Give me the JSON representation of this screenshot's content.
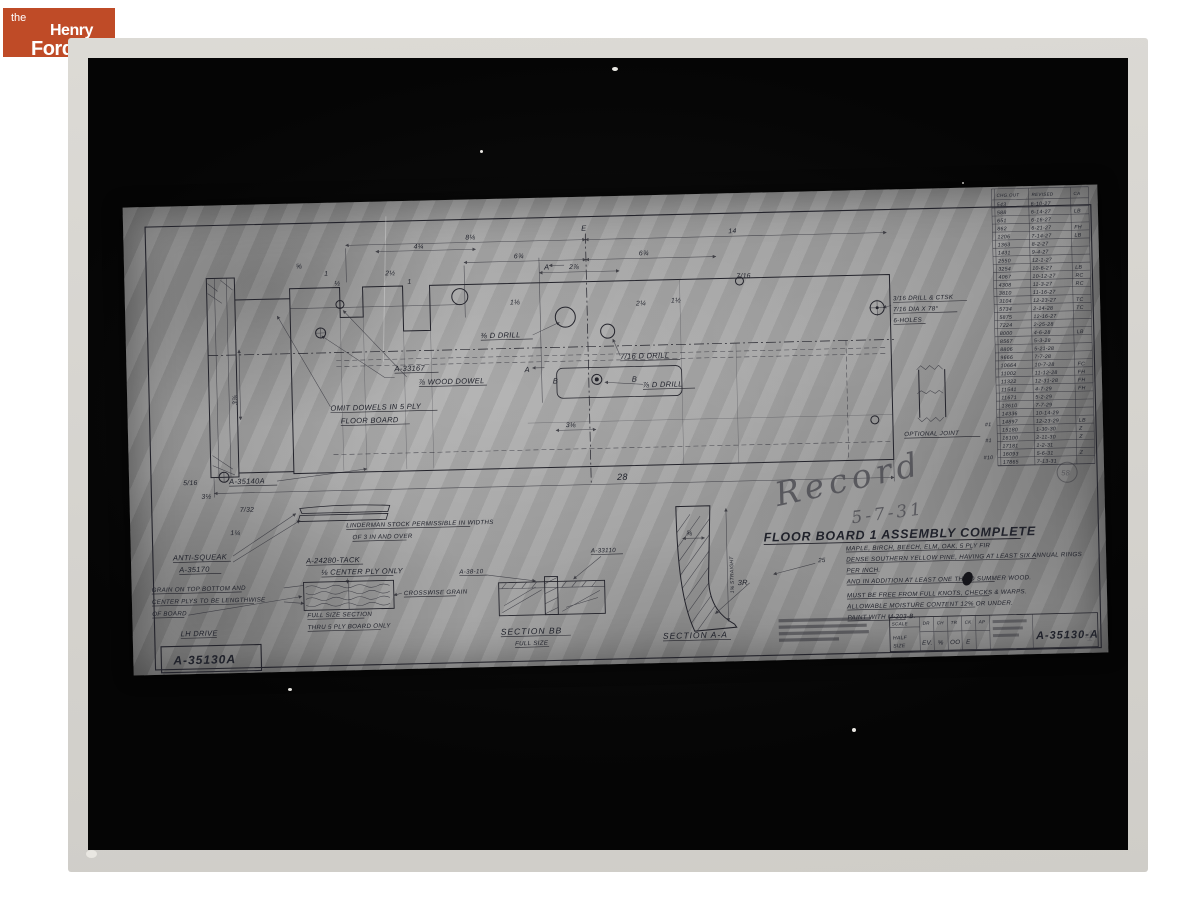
{
  "logo": {
    "the": "the",
    "henry": "Henry",
    "ford": "Ford",
    "bg": "#bf4b27"
  },
  "sheet": {
    "record": "Record",
    "record_date": "5-7-31",
    "title": "FLOOR BOARD 1 ASSEMBLY COMPLETE",
    "notes": [
      "MAPLE, BIRCH, BEECH, ELM, OAK, 5 PLY FIR",
      "DENSE SOUTHERN YELLOW PINE, HAVING AT LEAST SIX ANNUAL RINGS",
      "PER INCH.",
      "AND IN ADDITION AT LEAST ONE THIRD SUMMER WOOD.",
      "MUST BE FREE FROM FULL KNOTS, CHECKS & WARPS.",
      "ALLOWABLE MOISTURE CONTENT 12% OR UNDER.",
      "PAINT WITH M-203-B."
    ],
    "note_margin": "25",
    "labels": {
      "dowel_part": "A-33167",
      "dowel": "⅞ WOOD DOWEL",
      "omit1": "OMIT DOWELS IN 5 PLY",
      "omit2": "FLOOR BOARD",
      "a35140": "A-35140A",
      "anti1": "ANTI-SQUEAK",
      "anti2": "A-35170",
      "grain1": "GRAIN ON TOP BOTTOM AND",
      "grain2": "CENTER PLYS TO BE LENGTHWISE",
      "grain3": "OF BOARD",
      "lh": "LH DRIVE",
      "lind1": "LINDERMAN STOCK PERMISSIBLE IN WIDTHS",
      "lind2": "OF 3 IN AND OVER",
      "tack1": "A-24280-TACK",
      "tack2": "⅛ CENTER PLY ONLY",
      "full1": "FULL SIZE SECTION",
      "full2": "THRU 5 PLY BOARD ONLY",
      "cross": "CROSSWISE GRAIN",
      "a3810": "A-38-10",
      "a33110": "A-33110",
      "secbb1": "SECTION BB",
      "secbb2": "FULL SIZE",
      "secaa": "SECTION A-A",
      "straight": "1⅝ STRAIGHT",
      "r3": "3R",
      "drill38": "⅜ D DRILL",
      "drill716": "7/16 D DRILL",
      "drill78": "⅞ D DRILL",
      "ctsk1": "3/16 DRILL & CTSK",
      "ctsk2": "7/16 DIA X 78°",
      "ctsk3": "6-HOLES",
      "optjoint": "OPTIONAL JOINT"
    },
    "dims": {
      "d1": "4¼",
      "d2": "8⅛",
      "d3": "14",
      "d4": "6¾",
      "d5": "6¾",
      "d6": "2⅞",
      "d7": "7/16",
      "d8": "⅝",
      "d9": "1",
      "d10": "½",
      "d11": "2½",
      "d12": "1",
      "d13": "1⅛",
      "d14": "1½",
      "d15": "28",
      "d16": "3⅞",
      "d17": "3½",
      "d18": "5/16",
      "d19": "7/32",
      "d20": "1¼",
      "d21": "3⅛",
      "d22": "⅝",
      "d23": "2¼"
    },
    "markers": {
      "a": "A",
      "b": "B",
      "e": "E",
      "stamp": "58",
      "check": "4",
      "hash1": "#1",
      "hash2": "#1",
      "hash3": "#10"
    },
    "revision_table": {
      "headers": [
        "CHG.OUT",
        "REVISED",
        "CA"
      ],
      "rows": [
        [
          "543",
          "6-10-27",
          ""
        ],
        [
          "588",
          "6-14-27",
          "LB"
        ],
        [
          "651",
          "6-16-27",
          ""
        ],
        [
          "862",
          "6-21-27",
          "FH"
        ],
        [
          "1206",
          "7-14-27",
          "LB"
        ],
        [
          "1363",
          "8-2-27",
          ""
        ],
        [
          "1431",
          "9-4-27",
          ""
        ],
        [
          "2550",
          "12-1-27",
          ""
        ],
        [
          "3254",
          "10-6-27",
          "LB"
        ],
        [
          "4067",
          "10-12-27",
          "RC"
        ],
        [
          "4308",
          "11-3-27",
          "RC"
        ],
        [
          "3810",
          "11-16-27",
          ""
        ],
        [
          "3104",
          "12-23-27",
          "TC"
        ],
        [
          "5734",
          "2-14-28",
          "TC"
        ],
        [
          "5875",
          "12-16-27",
          ""
        ],
        [
          "7224",
          "2-25-28",
          ""
        ],
        [
          "8000",
          "4-6-28",
          "LB"
        ],
        [
          "8567",
          "5-3-28",
          ""
        ],
        [
          "8806",
          "5-21-28",
          ""
        ],
        [
          "9666",
          "7-7-28",
          ""
        ],
        [
          "10664",
          "10-7-28",
          "FC"
        ],
        [
          "11002",
          "11-12-28",
          "FH"
        ],
        [
          "11322",
          "12-31-28",
          "FH"
        ],
        [
          "11541",
          "4-7-29",
          "FH"
        ],
        [
          "11671",
          "5-2-29",
          ""
        ],
        [
          "13610",
          "7-7-29",
          ""
        ],
        [
          "14336",
          "10-14-29",
          ""
        ],
        [
          "14897",
          "12-23-29",
          "LB"
        ],
        [
          "15180",
          "1-30-30",
          "Z"
        ],
        [
          "16100",
          "2-11-30",
          "Z"
        ],
        [
          "17181",
          "1-2-31",
          ""
        ],
        [
          "16093",
          "5-6-31",
          "Z"
        ],
        [
          "17865",
          "7-13-31",
          ""
        ]
      ]
    },
    "title_block": {
      "scale_label": "SCALE",
      "scale_value1": "HALF",
      "scale_value2": "SIZE",
      "col_headers": [
        "DR",
        "CH",
        "TR",
        "CK",
        "AP"
      ],
      "col_values": [
        "EV.",
        "⅝",
        "OO",
        "E",
        ""
      ],
      "number": "A-35130-A"
    },
    "corner_number": "A-35130A"
  }
}
